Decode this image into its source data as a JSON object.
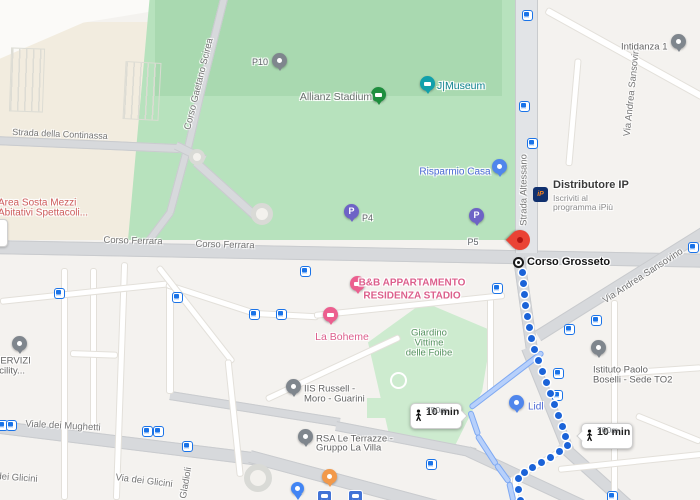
{
  "colors": {
    "route_blue": "#1b63d8",
    "alt_route_blue": "#b7d0fb",
    "park_green": "#b7e2bd",
    "poi_blue": "#4a68d4",
    "poi_pink": "#dc5f8c",
    "poi_teal": "#0d828e",
    "poi_red": "#cd5b5b",
    "poi_gray": "#636363",
    "park_text_green": "#55915f",
    "destination_red": "#ea4335"
  },
  "road_labels": {
    "scirea": "Corso Gaetano Scirea",
    "continassa": "Strada della Continassa",
    "ferrara_1": "Corso Ferrara",
    "ferrara_2": "Corso Ferrara",
    "altessano": "Strada Altessano",
    "sansovino_north": "Via Andrea Sansovino",
    "sansovino_south": "Via Andrea Sansovino",
    "mughetti": "Viale dei Mughetti",
    "glicini_left": "dei Glicini",
    "glicini": "Via dei Glicini",
    "gladioli": "Gladioli"
  },
  "pois": {
    "p10": "P10",
    "p4": "P4",
    "p5": "P5",
    "parking_glyph": "P",
    "allianz": "Allianz Stadium",
    "jmuseum": "J|Museum",
    "risparmio": "Risparmio Casa",
    "distributore": {
      "logo": "iP",
      "title": "Distributore IP",
      "subtitle_1": "Iscriviti al",
      "subtitle_2": "programma iPiù"
    },
    "area_sosta": {
      "line1": "Area Sosta Mezzi",
      "line2": "Abitativi Spettacoli..."
    },
    "corso_grosseto": "Corso Grosseto",
    "bnb": {
      "line1": "B&B APPARTAMENTO",
      "line2": "RESIDENZA STADIO"
    },
    "la_boheme": "La Boheme",
    "giardino": {
      "line1": "Giardino",
      "line2": "Vittime",
      "line3": "delle Foibe"
    },
    "russell": {
      "line1": "IIS Russell -",
      "line2": "Moro - Guarini"
    },
    "rsa": {
      "line1": "RSA Le Terrazze -",
      "line2": "Gruppo La Villa"
    },
    "lidl": "Lidl",
    "boselli": {
      "line1": "Istituto Paolo",
      "line2": "Boselli - Sede TO2"
    },
    "intidanza": "Intidanza 1",
    "servizi": {
      "line1": "SERVIZI",
      "line2": "acility..."
    }
  },
  "route": {
    "badge_1": {
      "time": "10 min",
      "distance": "750m"
    },
    "badge_2": {
      "time": "10 min",
      "distance": "700m"
    }
  },
  "geometry": {
    "gray_roads": [
      [
        -10,
        240,
        720,
        14,
        1.1
      ],
      [
        519,
        252,
        95,
        12,
        82
      ],
      [
        527,
        342,
        110,
        12,
        68
      ],
      [
        560,
        438,
        100,
        12,
        42
      ],
      [
        538,
        330,
        198,
        12,
        -32
      ],
      [
        170,
        391,
        172,
        9,
        9
      ],
      [
        336,
        421,
        142,
        10,
        11
      ],
      [
        468,
        446,
        130,
        11,
        25
      ],
      [
        -8,
        420,
        268,
        13,
        7
      ],
      [
        250,
        450,
        205,
        13,
        15
      ],
      [
        205,
        71,
        82,
        8,
        -76
      ],
      [
        188,
        144,
        75,
        8,
        -77
      ],
      [
        170,
        209,
        67,
        8,
        -75
      ],
      [
        148,
        238,
        37,
        8,
        -53
      ],
      [
        -5,
        136,
        185,
        9,
        2.5
      ],
      [
        176,
        141,
        32,
        9,
        26
      ],
      [
        196,
        158,
        82,
        9,
        42
      ]
    ],
    "white_roads": [
      [
        61,
        268,
        7,
        232,
        0
      ],
      [
        90,
        268,
        7,
        160,
        0
      ],
      [
        117,
        262,
        7,
        238,
        2
      ],
      [
        166,
        280,
        8,
        114,
        0
      ],
      [
        487,
        298,
        7,
        97,
        0
      ],
      [
        611,
        300,
        7,
        200,
        0
      ],
      [
        570,
        58,
        7,
        108,
        5
      ],
      [
        0,
        298,
        172,
        7,
        -6
      ],
      [
        166,
        281,
        98,
        7,
        18
      ],
      [
        255,
        310,
        64,
        7,
        3
      ],
      [
        314,
        312,
        192,
        7,
        -6
      ],
      [
        158,
        263,
        122,
        7,
        52
      ],
      [
        228,
        356,
        118,
        7,
        84
      ],
      [
        266,
        396,
        148,
        7,
        -25
      ],
      [
        510,
        478,
        64,
        7,
        -31
      ],
      [
        512,
        476,
        7,
        26,
        0
      ],
      [
        546,
        6,
        180,
        8,
        29
      ],
      [
        618,
        370,
        84,
        7,
        -4
      ],
      [
        558,
        466,
        145,
        7,
        -6
      ],
      [
        70,
        350,
        48,
        7,
        2
      ],
      [
        636,
        412,
        70,
        7,
        22
      ]
    ],
    "alt_route": [
      [
        470,
        405,
        92,
        -37.5
      ],
      [
        470,
        408,
        26,
        71
      ],
      [
        477,
        432,
        36,
        57
      ],
      [
        496,
        461,
        23,
        54
      ],
      [
        509,
        479,
        20,
        77
      ]
    ],
    "route_dots": [
      [
        522,
        272
      ],
      [
        523,
        283
      ],
      [
        524,
        294
      ],
      [
        525,
        305
      ],
      [
        527,
        316
      ],
      [
        529,
        327
      ],
      [
        531,
        338
      ],
      [
        534,
        349
      ],
      [
        538,
        360
      ],
      [
        542,
        371
      ],
      [
        546,
        382
      ],
      [
        550,
        393
      ],
      [
        554,
        404
      ],
      [
        558,
        415
      ],
      [
        562,
        426
      ],
      [
        565,
        436
      ],
      [
        567,
        445
      ],
      [
        559,
        451
      ],
      [
        550,
        457
      ],
      [
        541,
        462
      ],
      [
        532,
        467
      ],
      [
        524,
        472
      ],
      [
        518,
        478
      ],
      [
        518,
        489
      ],
      [
        520,
        500
      ]
    ],
    "transit_stops": [
      [
        527,
        15
      ],
      [
        524,
        106
      ],
      [
        532,
        143
      ],
      [
        693,
        247
      ],
      [
        305,
        271
      ],
      [
        497,
        288
      ],
      [
        59,
        293
      ],
      [
        177,
        297
      ],
      [
        254,
        314
      ],
      [
        281,
        314
      ],
      [
        569,
        329
      ],
      [
        596,
        320
      ],
      [
        558,
        373
      ],
      [
        557,
        395
      ],
      [
        2,
        425
      ],
      [
        11,
        425
      ],
      [
        147,
        431
      ],
      [
        158,
        431
      ],
      [
        187,
        446
      ],
      [
        431,
        464
      ],
      [
        612,
        496
      ]
    ],
    "stations": [
      [
        324,
        497
      ],
      [
        355,
        497
      ]
    ]
  }
}
